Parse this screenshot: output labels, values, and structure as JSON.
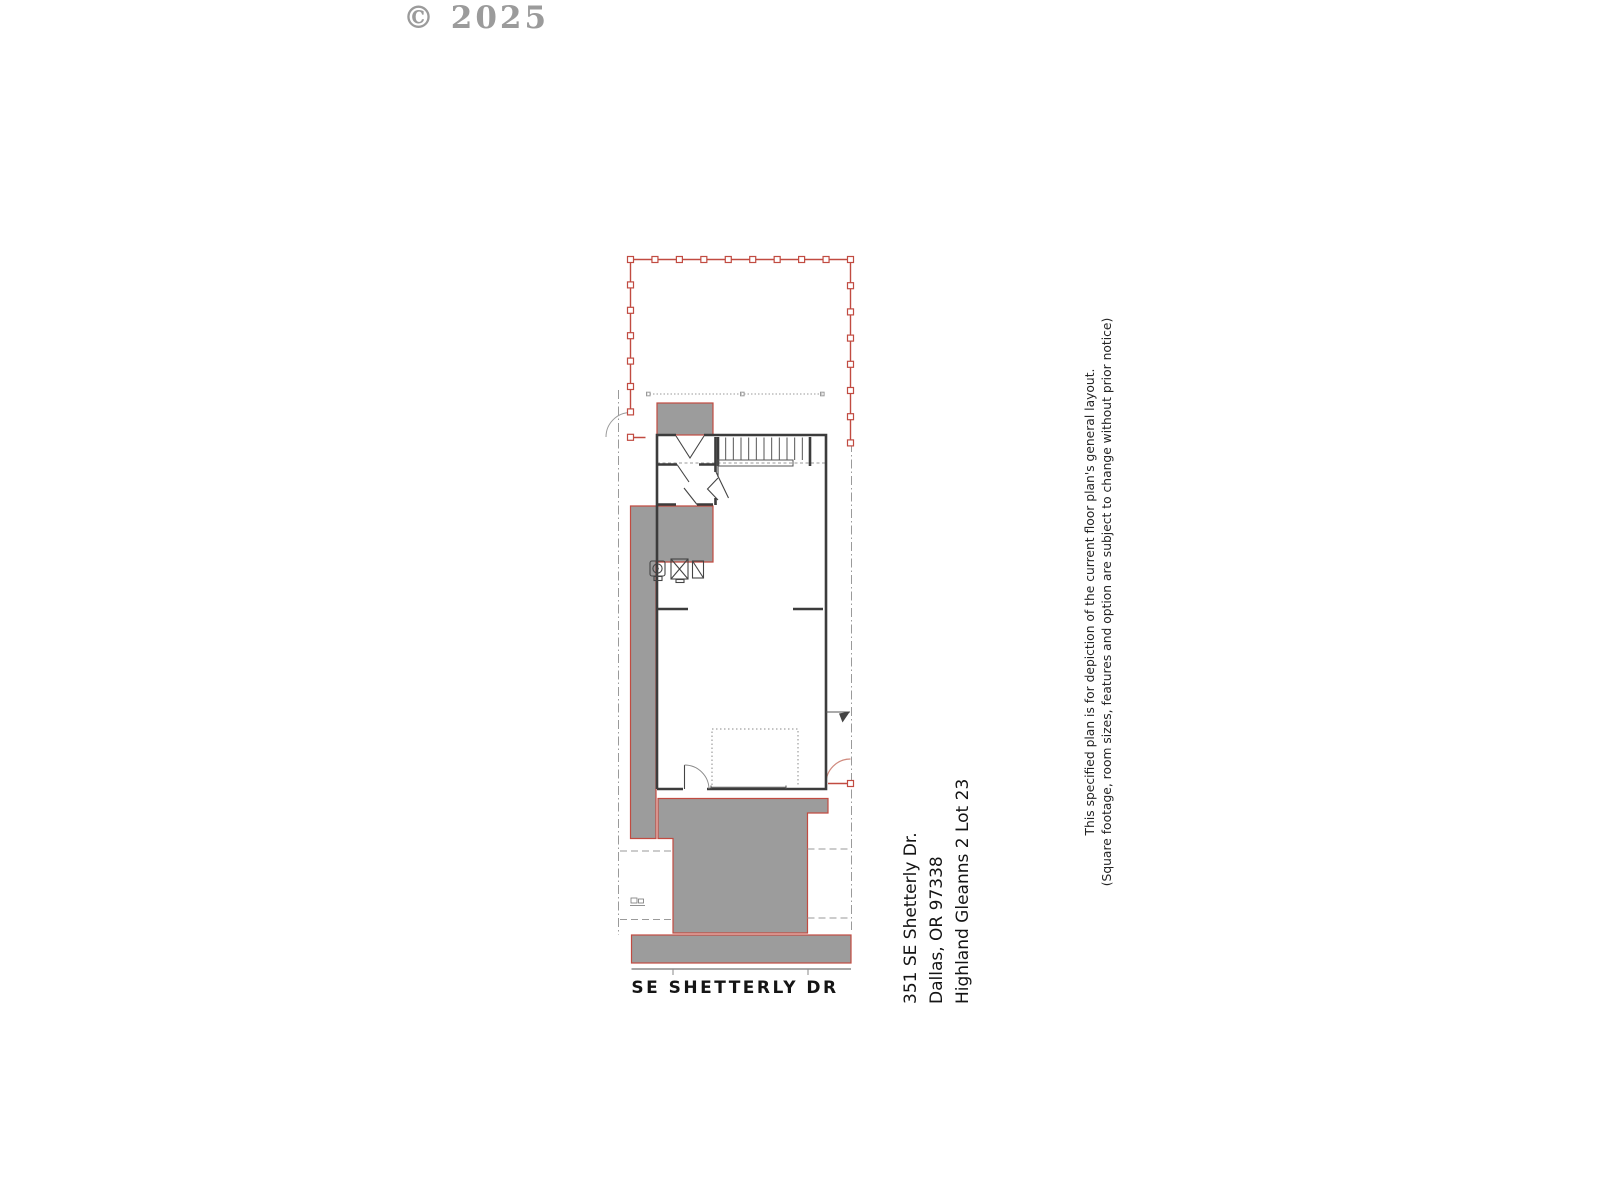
{
  "watermark": "© 2025",
  "street_label": "SE SHETTERLY DR",
  "address": {
    "line1": "351 SE Shetterly Dr.",
    "line2": "Dallas, OR 97338",
    "line3": "Highland Gleanns 2 Lot 23"
  },
  "disclaimer": {
    "line1": "This specified plan is for depiction of the current floor plan's general layout.",
    "line2": "(Square footage, room sizes, features and option are subject to change without prior notice)"
  },
  "colors": {
    "boundary_red": "#c14b41",
    "shaded_gray": "#9c9c9c",
    "wall_dark": "#3c3c3c",
    "line_gray": "#9a9a9a",
    "watermark_gray": "#9b9b9b",
    "gate_arc_red": "#d08a7e"
  }
}
